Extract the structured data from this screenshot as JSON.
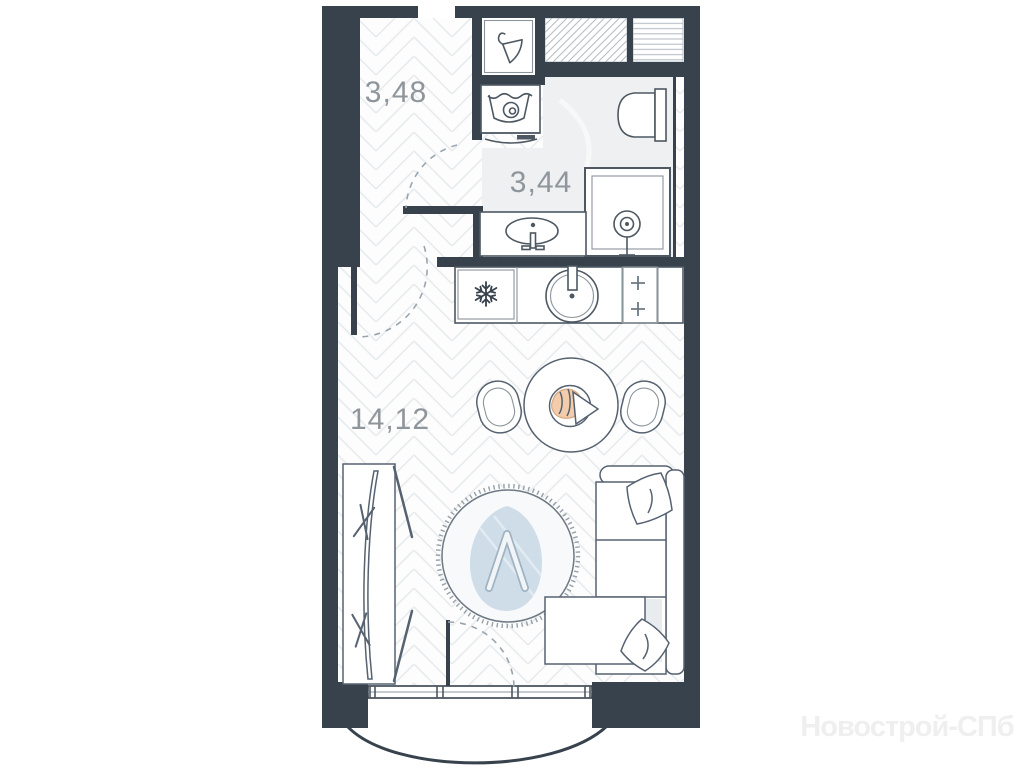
{
  "floorplan": {
    "title": "studio-apartment-floor-plan",
    "rooms": [
      {
        "name": "hallway",
        "area": "3,48"
      },
      {
        "name": "bathroom",
        "area": "3,44"
      },
      {
        "name": "living-kitchen",
        "area": "14,12"
      }
    ],
    "watermark": "Новострой-СПб",
    "fixtures": [
      "entry-wardrobe-hanger",
      "washing-machine",
      "toilet",
      "shower-cabin",
      "bathroom-sink",
      "refrigerator",
      "kitchen-sink",
      "stove-burners",
      "dining-table",
      "dining-chairs",
      "round-rug",
      "sofa-with-pillows",
      "wardrobe-with-rail",
      "window",
      "balcony",
      "door-swing-arcs",
      "ventilation-shafts"
    ],
    "colors": {
      "wall": "#37424d",
      "outline": "#4d5862",
      "floor_line": "#e9ecee",
      "marble_floor": "#eef0f2",
      "label_text": "#8e959b",
      "rug_motif": "#cfdde9",
      "food_accent": "#f3cdab",
      "watermark_text": "#efefef"
    }
  }
}
